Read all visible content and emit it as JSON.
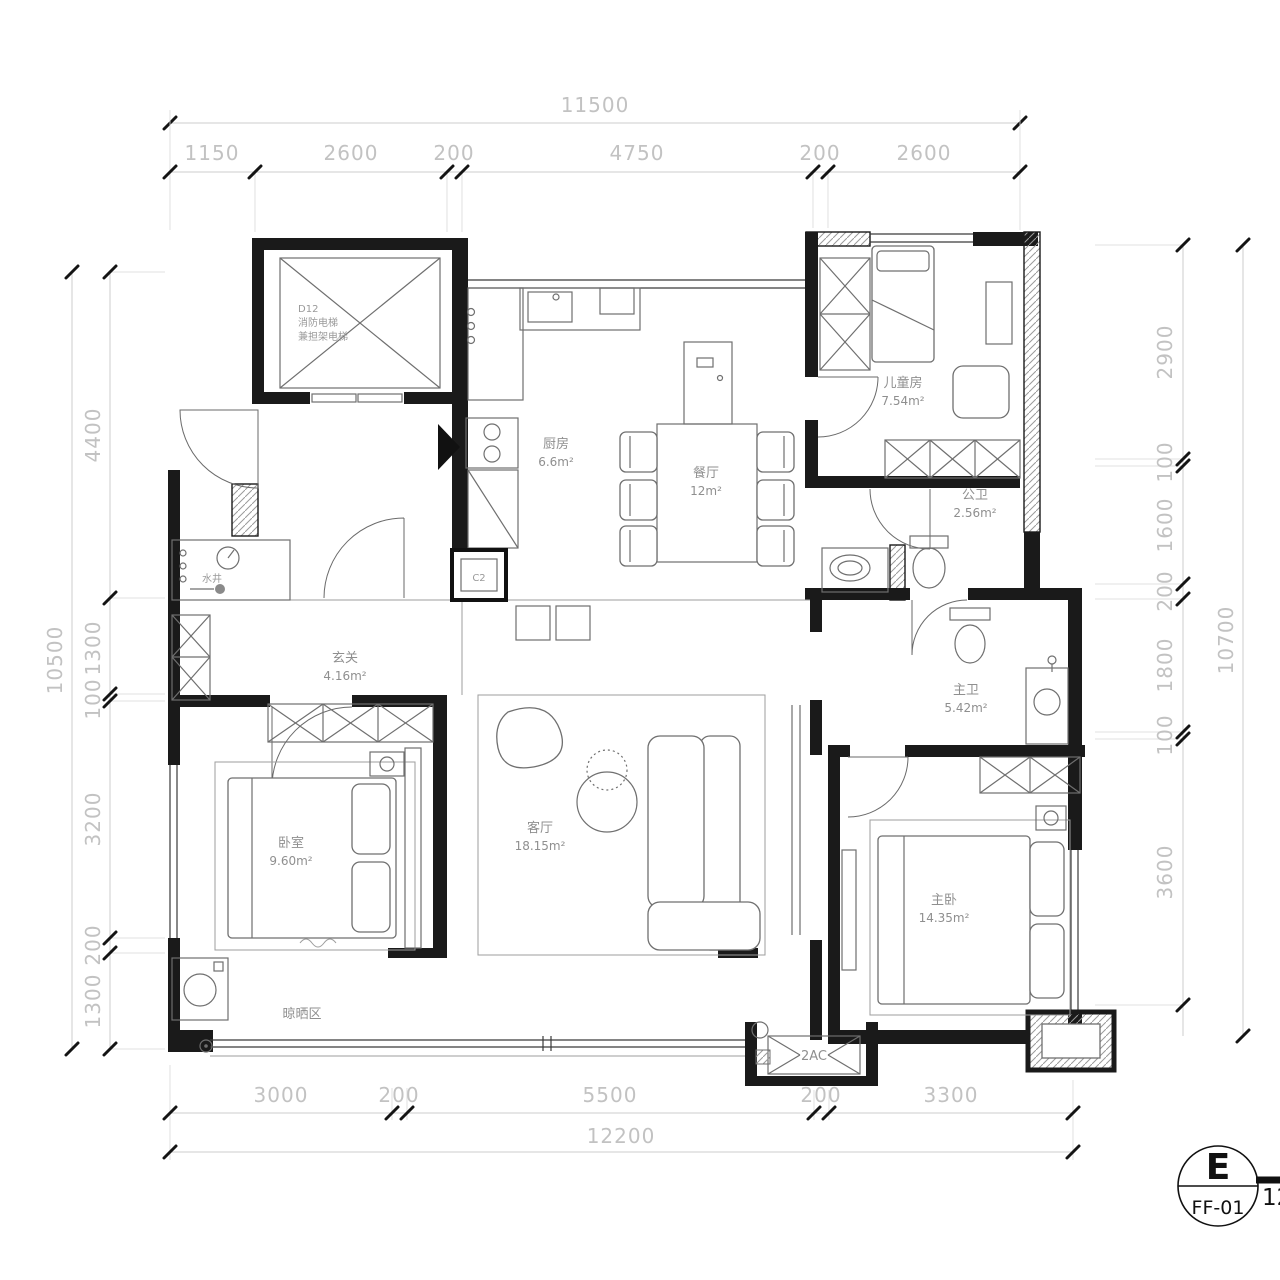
{
  "dims": {
    "top": {
      "total": "11500",
      "segs": [
        "1150",
        "2600",
        "200",
        "4750",
        "200",
        "2600"
      ]
    },
    "bottom": {
      "total": "12200",
      "segs": [
        "3000",
        "200",
        "5500",
        "200",
        "3300"
      ]
    },
    "left": {
      "total": "10500",
      "segs": [
        "4400",
        "1300",
        "100",
        "3200",
        "200",
        "1300"
      ]
    },
    "right": {
      "total": "10700",
      "segs": [
        "2900",
        "100",
        "1600",
        "200",
        "1800",
        "100",
        "3600"
      ]
    }
  },
  "rooms": {
    "elevator": {
      "code": "D12",
      "line1": "消防电梯",
      "line2": "兼担架电梯"
    },
    "shaft": {
      "name": "水井"
    },
    "entry": {
      "name": "玄关",
      "area": "4.16m²"
    },
    "kitchen": {
      "name": "厨房",
      "area": "6.6m²"
    },
    "dining": {
      "name": "餐厅",
      "area": "12m²"
    },
    "kids": {
      "name": "儿童房",
      "area": "7.54m²"
    },
    "bath_public": {
      "name": "公卫",
      "area": "2.56m²"
    },
    "bath_master": {
      "name": "主卫",
      "area": "5.42m²"
    },
    "bedroom": {
      "name": "卧室",
      "area": "9.60m²"
    },
    "living": {
      "name": "客厅",
      "area": "18.15m²"
    },
    "master": {
      "name": "主卧",
      "area": "14.35m²"
    },
    "drying": {
      "name": "晾晒区"
    }
  },
  "labels": {
    "ac": "2AC",
    "c2": "C2"
  },
  "title_block": {
    "letter": "E",
    "ref": "FF-01",
    "number": "12"
  },
  "colors": {
    "wall": "#1a1a1a",
    "dim_text": "#c2c2c2",
    "room_text": "#8f8f8f"
  }
}
